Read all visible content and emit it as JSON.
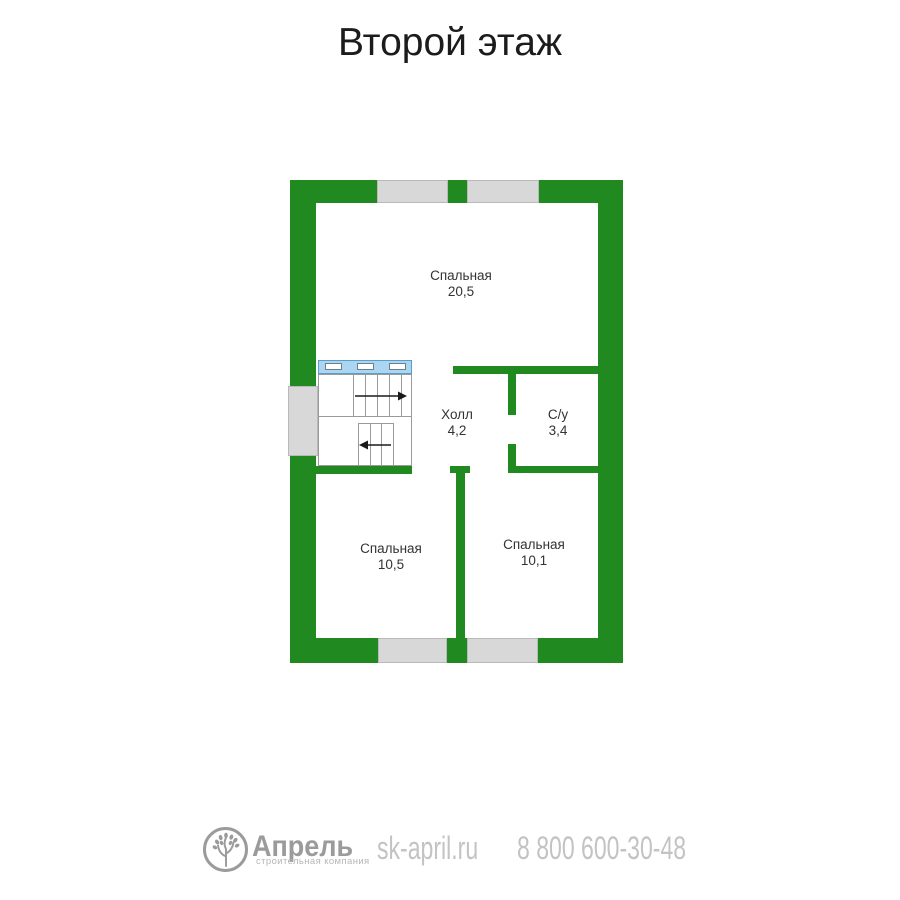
{
  "page": {
    "title": "Второй этаж"
  },
  "colors": {
    "wall_green": "#208a20",
    "window_gray": "#d8d8d8",
    "window_border": "#b9b9b9",
    "stair_rail_blue": "#abd6f1",
    "stair_rail_border": "#5b9dc9",
    "room_label_text": "#333333",
    "footer_dark_gray": "#9b9b9b",
    "footer_light_gray": "#c3c3c3"
  },
  "rooms": [
    {
      "name": "Спальная",
      "area": "20,5"
    },
    {
      "name": "Холл",
      "area": "4,2"
    },
    {
      "name": "С/у",
      "area": "3,4"
    },
    {
      "name": "Спальная",
      "area": "10,5"
    },
    {
      "name": "Спальная",
      "area": "10,1"
    }
  ],
  "stairs": {
    "up_arrow_icon": "arrow-right",
    "down_arrow_icon": "arrow-left"
  },
  "footer": {
    "logo_icon": "tree-in-circle-icon",
    "company": "Апрель",
    "tagline": "строительная компания",
    "website": "sk-april.ru",
    "phone": "8 800 600-30-48"
  }
}
